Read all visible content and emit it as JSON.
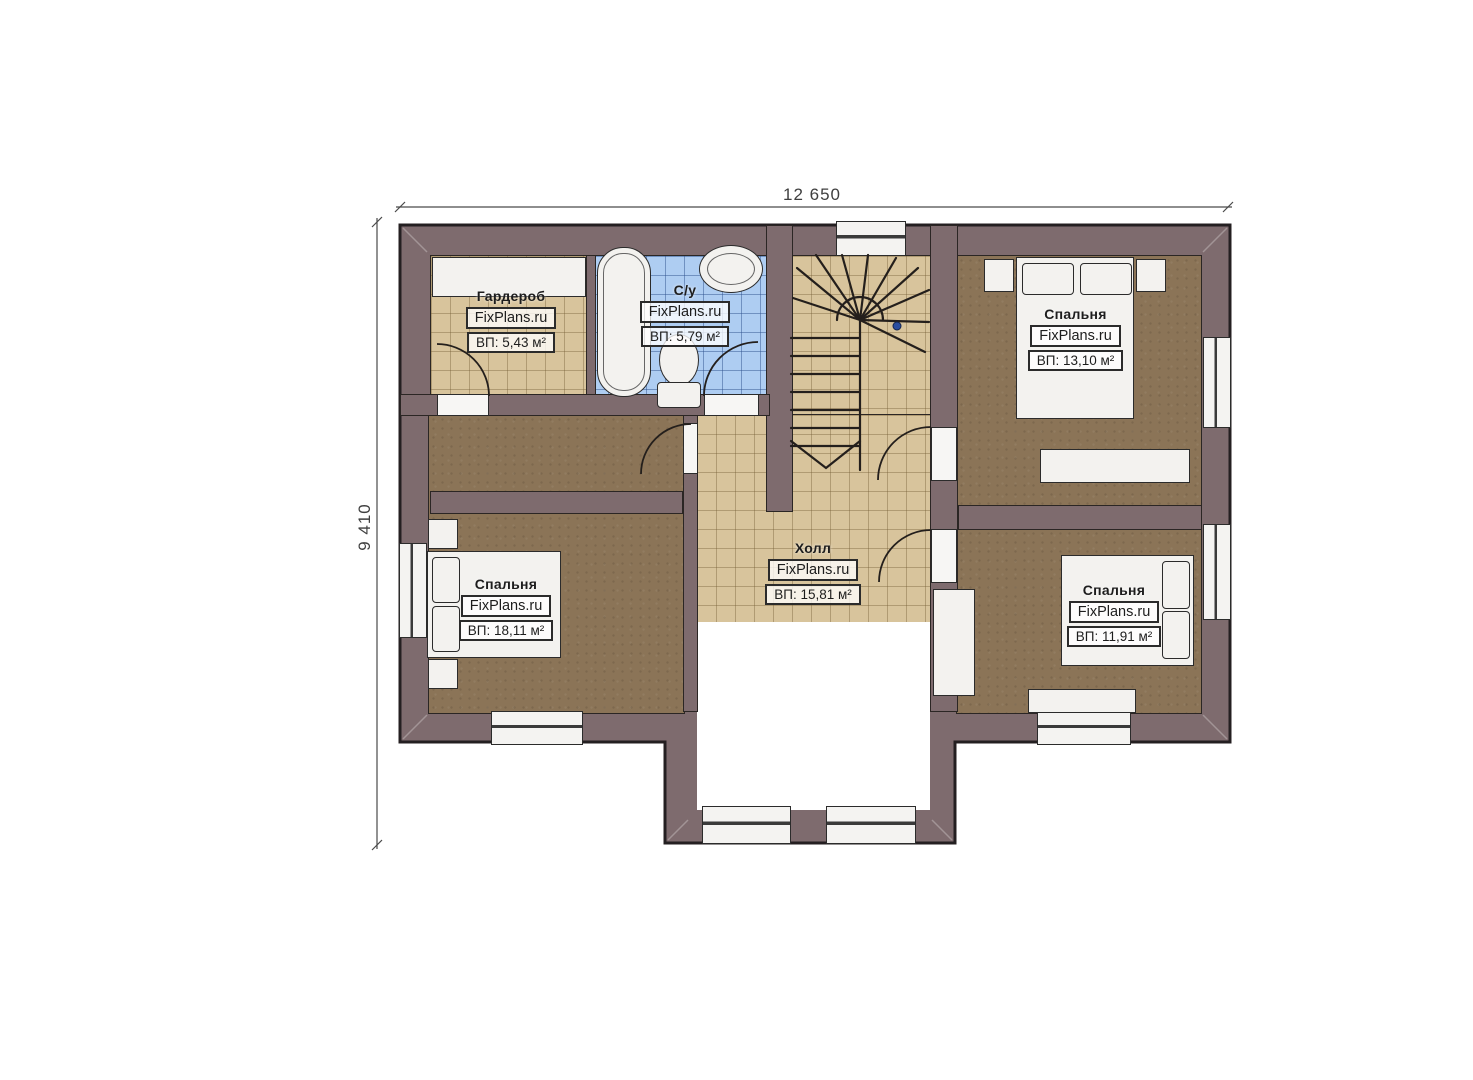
{
  "plan": {
    "width_dimension": "12 650",
    "height_dimension": "9 410"
  },
  "rooms": [
    {
      "id": "wardrobe",
      "name": "Гардероб",
      "brand": "FixPlans.ru",
      "area": "ВП: 5,43 м²"
    },
    {
      "id": "bathroom",
      "name": "С/у",
      "brand": "FixPlans.ru",
      "area": "ВП: 5,79 м²"
    },
    {
      "id": "bedroom-top-right",
      "name": "Спальня",
      "brand": "FixPlans.ru",
      "area": "ВП: 13,10 м²"
    },
    {
      "id": "hall",
      "name": "Холл",
      "brand": "FixPlans.ru",
      "area": "ВП: 15,81 м²"
    },
    {
      "id": "bedroom-left",
      "name": "Спальня",
      "brand": "FixPlans.ru",
      "area": "ВП: 18,11 м²"
    },
    {
      "id": "bedroom-bottom-right",
      "name": "Спальня",
      "brand": "FixPlans.ru",
      "area": "ВП: 11,91 м²"
    }
  ],
  "colors": {
    "wall": "#7e6b6e",
    "tile_beige": "#d8c49c",
    "tile_blue": "#aecdf2",
    "carpet": "#8b7457",
    "outline": "#2b2624",
    "stair_dot": "#2b4ea0"
  }
}
